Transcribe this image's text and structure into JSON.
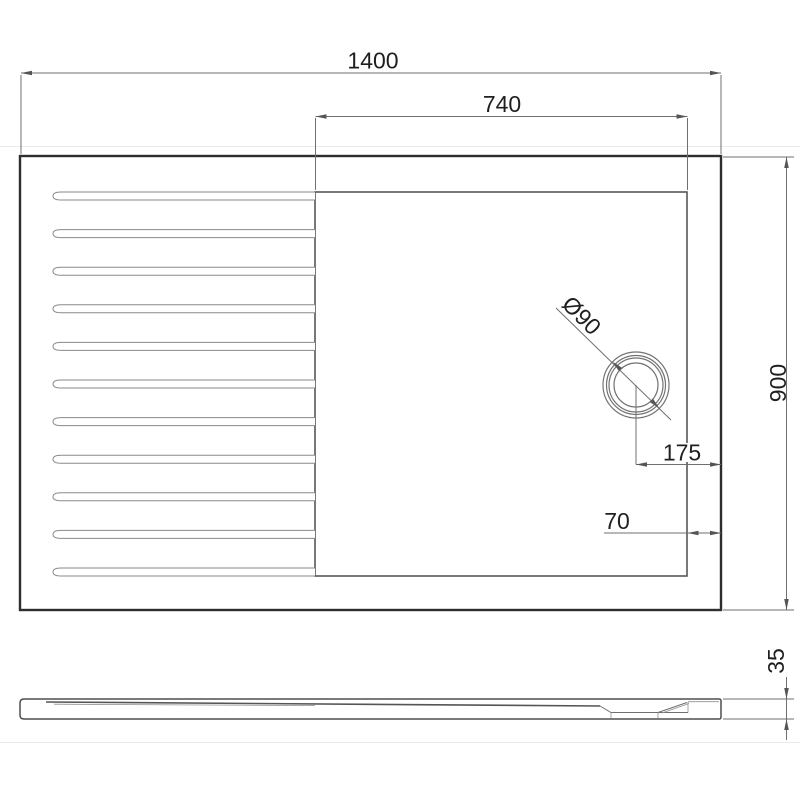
{
  "drawing": {
    "dimensions": {
      "total_width": "1400",
      "shower_zone_width": "740",
      "total_depth": "900",
      "drain_center_to_edge": "175",
      "border_width": "70",
      "tray_height": "35",
      "drain_diameter": "Ø90"
    },
    "colors": {
      "background": "#ffffff",
      "outline": "#2e2e2e",
      "thin_line": "#6f6f6f",
      "label_text": "#1f1f1f"
    }
  }
}
